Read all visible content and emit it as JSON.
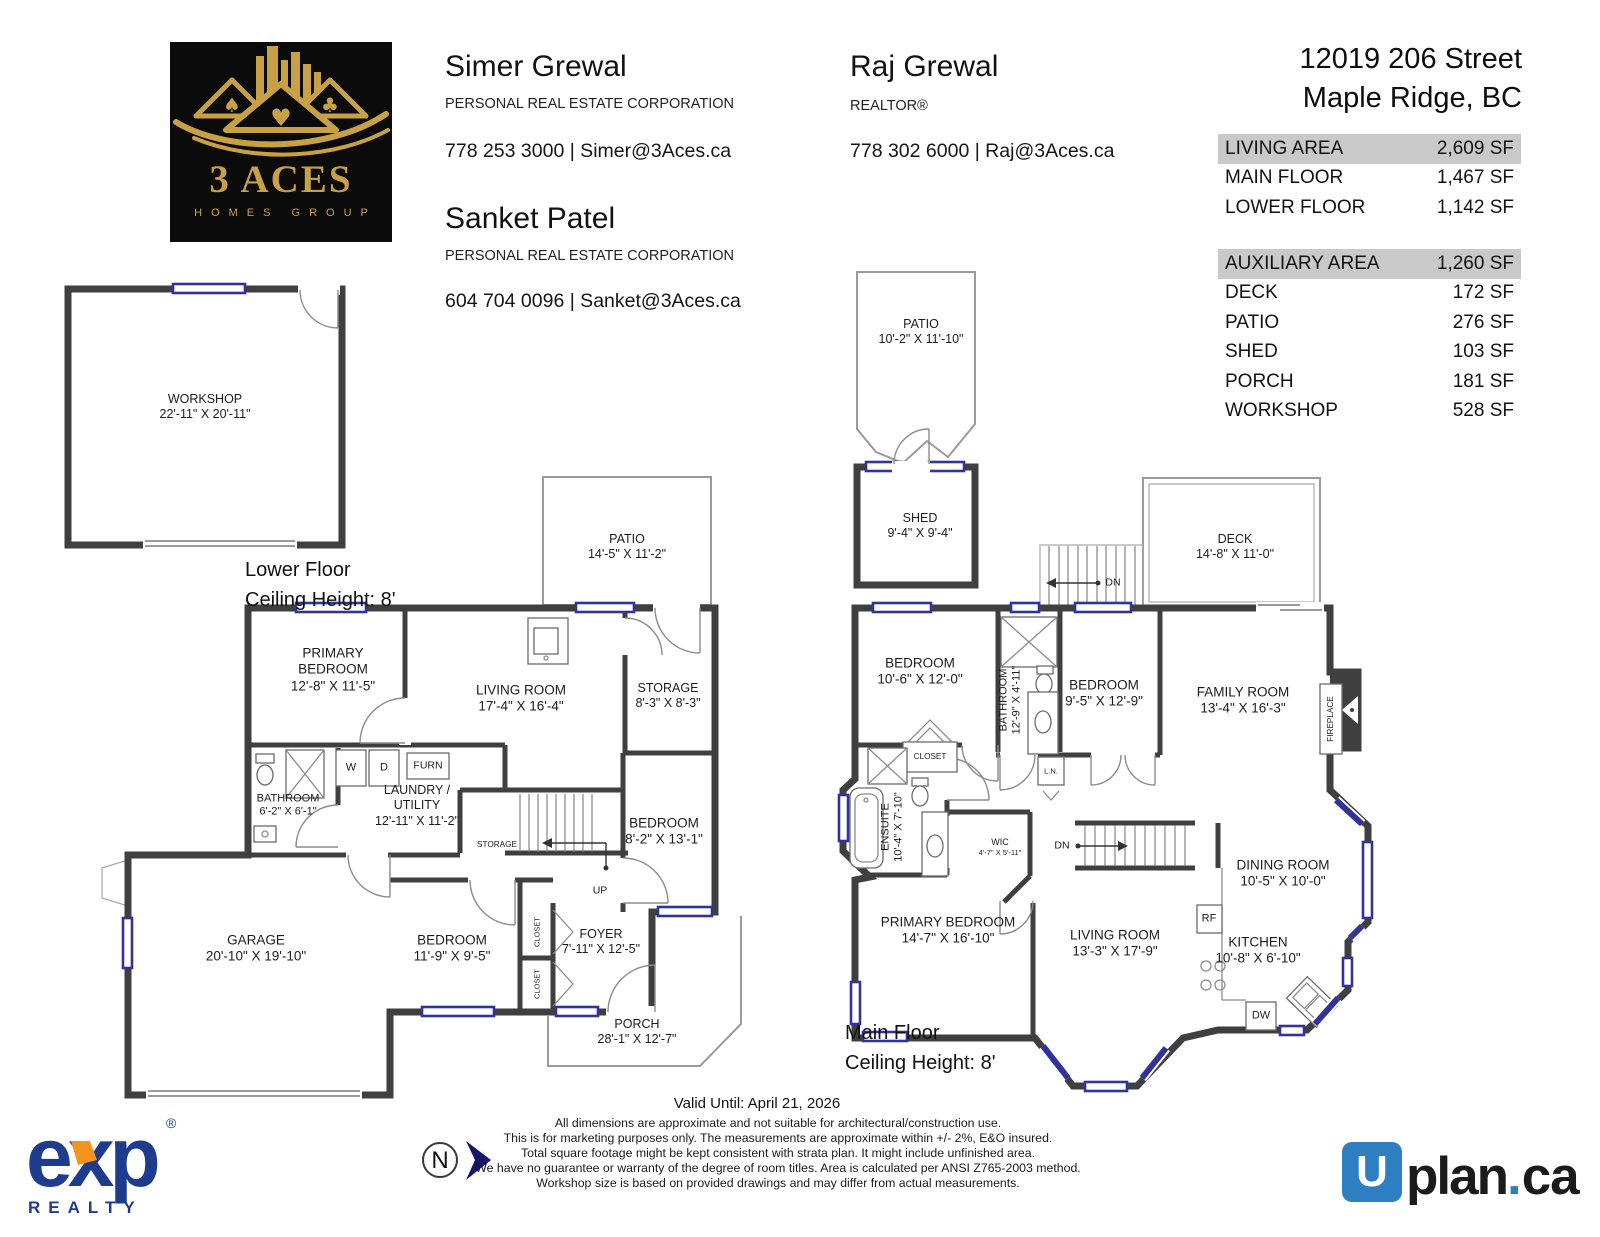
{
  "header": {
    "brand": {
      "name_top": "3 ACES",
      "name_bottom": "HOMES GROUP",
      "suits": [
        "♠",
        "♥",
        "♣"
      ]
    },
    "agents": [
      {
        "name": "Simer Grewal",
        "title": "PERSONAL REAL ESTATE CORPORATION",
        "contact": "778 253 3000 | Simer@3Aces.ca"
      },
      {
        "name": "Sanket Patel",
        "title": "PERSONAL REAL ESTATE CORPORATION",
        "contact": "604 704 0096 | Sanket@3Aces.ca"
      },
      {
        "name": "Raj Grewal",
        "title": "REALTOR®",
        "contact": "778 302 6000 | Raj@3Aces.ca"
      }
    ],
    "address": {
      "line1": "12019 206 Street",
      "line2": "Maple Ridge, BC"
    }
  },
  "area_tables": {
    "living": {
      "header": {
        "label": "LIVING AREA",
        "value": "2,609 SF"
      },
      "rows": [
        {
          "label": "MAIN FLOOR",
          "value": "1,467 SF"
        },
        {
          "label": "LOWER FLOOR",
          "value": "1,142 SF"
        }
      ]
    },
    "auxiliary": {
      "header": {
        "label": "AUXILIARY AREA",
        "value": "1,260 SF"
      },
      "rows": [
        {
          "label": "DECK",
          "value": "172 SF"
        },
        {
          "label": "PATIO",
          "value": "276 SF"
        },
        {
          "label": "SHED",
          "value": "103 SF"
        },
        {
          "label": "PORCH",
          "value": "181 SF"
        },
        {
          "label": "WORKSHOP",
          "value": "528 SF"
        }
      ]
    }
  },
  "floors": {
    "lower": {
      "title": "Lower Floor",
      "ceiling": "Ceiling Height: 8'"
    },
    "main": {
      "title": "Main Floor",
      "ceiling": "Ceiling Height: 8'"
    }
  },
  "plans": {
    "workshop": {
      "name": "WORKSHOP",
      "dims": "22'-11\" X 20'-11\""
    },
    "lower": {
      "rooms": [
        {
          "name": "PATIO",
          "dims": "14'-5\"  X  11'-2\""
        },
        {
          "name": "PRIMARY\nBEDROOM",
          "dims": "12'-8\"  X  11'-5\""
        },
        {
          "name": "LIVING ROOM",
          "dims": "17'-4\"  X  16'-4\""
        },
        {
          "name": "STORAGE",
          "dims": "8'-3\"   X   8'-3\""
        },
        {
          "name": "BATHROOM",
          "dims": "6'-2\"   X   6'-1\""
        },
        {
          "name": "LAUNDRY /\nUTILITY",
          "dims": "12'-11\" X  11'-2\""
        },
        {
          "name": "W"
        },
        {
          "name": "D"
        },
        {
          "name": "FURN"
        },
        {
          "name": "STORAGE"
        },
        {
          "name": "UP"
        },
        {
          "name": "BEDROOM",
          "dims": "8'-2\"   X  13'-1\""
        },
        {
          "name": "GARAGE",
          "dims": "20'-10\" X 19'-10\""
        },
        {
          "name": "BEDROOM",
          "dims": "11'-9\"  X   9'-5\""
        },
        {
          "name": "CLOSET"
        },
        {
          "name": "CLOSET"
        },
        {
          "name": "FOYER",
          "dims": "7'-11\"  X  12'-5\""
        },
        {
          "name": "PORCH",
          "dims": "28'-1\"  X  12'-7\""
        }
      ]
    },
    "main": {
      "rooms": [
        {
          "name": "PATIO",
          "dims": "10'-2\"  X 11'-10\""
        },
        {
          "name": "SHED",
          "dims": "9'-4\"   X   9'-4\""
        },
        {
          "name": "DECK",
          "dims": "14'-8\"  X  11'-0\""
        },
        {
          "name": "DN"
        },
        {
          "name": "BEDROOM",
          "dims": "10'-6\"  X  12'-0\""
        },
        {
          "name": "BATHROOM",
          "dims": "12'-9\" X 4'-11\""
        },
        {
          "name": "BEDROOM",
          "dims": "9'-5\"   X  12'-9\""
        },
        {
          "name": "FAMILY ROOM",
          "dims": "13'-4\"  X  16'-3\""
        },
        {
          "name": "FIREPLACE"
        },
        {
          "name": "CLOSET"
        },
        {
          "name": "L.N."
        },
        {
          "name": "ENSUITE",
          "dims": "10'-4\" X 7'-10\""
        },
        {
          "name": "WIC",
          "dims": "4'-7\"  X  5'-11\""
        },
        {
          "name": "DN"
        },
        {
          "name": "PRIMARY BEDROOM",
          "dims": "14'-7\"  X 16'-10\""
        },
        {
          "name": "LIVING ROOM",
          "dims": "13'-3\"  X  17'-9\""
        },
        {
          "name": "DINING ROOM",
          "dims": "10'-5\"  X  10'-0\""
        },
        {
          "name": "KITCHEN",
          "dims": "10'-8\"  X  6'-10\""
        },
        {
          "name": "RF"
        },
        {
          "name": "DW"
        }
      ]
    }
  },
  "footer": {
    "valid_until": "Valid Until: April 21, 2026",
    "disclaimer": [
      "All dimensions are approximate and not suitable for architectural/construction use.",
      "This is for marketing purposes only. The measurements are approximate within +/- 2%, E&O insured.",
      "Total square footage might be kept consistent with strata plan. It might include unfinished area.",
      "We have no guarantee or warranty of the degree of room titles. Area is calculated per ANSI Z765-2003 method.",
      "Workshop size is based on provided drawings and may differ from actual measurements."
    ],
    "exp": {
      "word": "exp",
      "sub": "REALTY",
      "reg": "®"
    },
    "uplan": {
      "u": "U",
      "plan": "plan",
      "dot": ".",
      "ca": "ca"
    }
  },
  "compass": {
    "letter": "N"
  },
  "colors": {
    "wall": "#3f3f3f",
    "window_accent": "#32329b",
    "gold": "#c9a145",
    "exp_navy": "#1e3b8e",
    "exp_orange": "#f6921e",
    "uplan_blue": "#2d7fc1",
    "table_highlight": "#c9c9c9"
  }
}
